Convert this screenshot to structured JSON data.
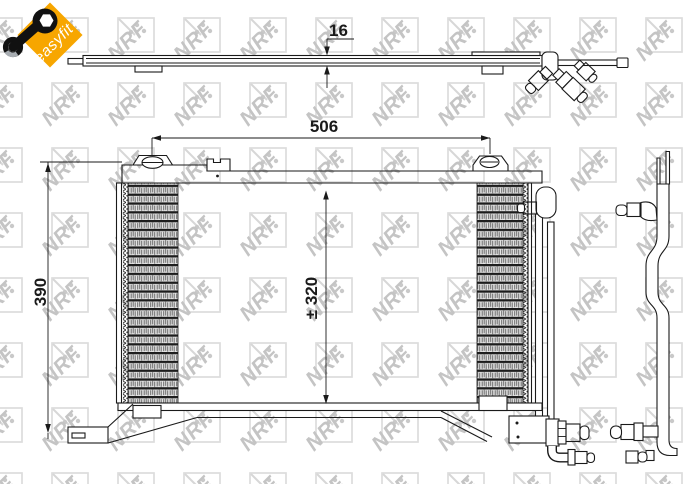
{
  "badge": {
    "label": "easyfit",
    "background": "#f7a600",
    "text_color": "#ffffff",
    "icon": "wrench-icon"
  },
  "watermark": {
    "text": "NRF",
    "letter_color": "#c4c4c4",
    "box_color": "#dcdcdc"
  },
  "drawing": {
    "line_color": "#1a1a1a",
    "views": {
      "top": "condenser-top-profile",
      "front": "condenser-front-view"
    },
    "dimensions": {
      "depth": {
        "label": "16"
      },
      "width": {
        "label": "506"
      },
      "height": {
        "label": "390"
      },
      "core_height": {
        "label": "± 320"
      }
    }
  }
}
